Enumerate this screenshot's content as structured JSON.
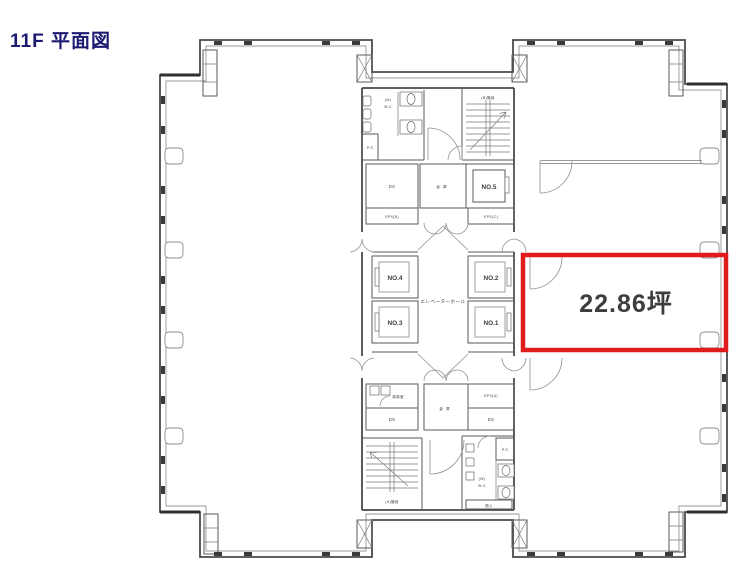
{
  "title": "11F 平面図",
  "floor_plan": {
    "highlighted_room": {
      "area": "22.86坪"
    },
    "elevator_hall_label": "エレベーターホール",
    "elevators": {
      "no1": "NO.1",
      "no2": "NO.2",
      "no3": "NO.3",
      "no4": "NO.4",
      "no5": "NO.5"
    },
    "labels": {
      "eps_a": "EPS(A)",
      "eps_b": "EPS(B)",
      "eps_c": "EPS(C)",
      "ds": "DS",
      "storage": "倉庫",
      "kitchenette": "湯沸室",
      "closet": "物入",
      "wc_men_l1": "(M)",
      "wc_men_l2": "W.C",
      "wc_women_l1": "(W)",
      "wc_women_l2": "W.C",
      "ps": "P.S",
      "stair_a": "(A)階段",
      "stair_b": "(B)階段"
    },
    "colors": {
      "highlight": "#e01b1b",
      "title_text": "#1c1a70",
      "walls": "#4a4a4a"
    }
  }
}
